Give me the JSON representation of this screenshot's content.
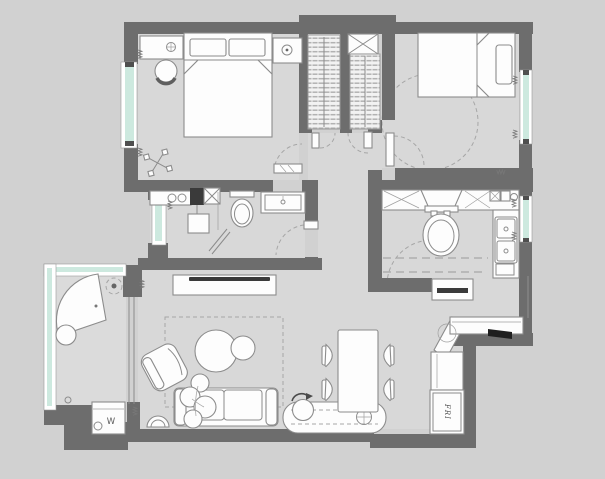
{
  "plan": {
    "labels": {
      "washing_machine": "W",
      "fridge": "FRI"
    }
  },
  "colors": {
    "background": "#d1d1d1",
    "floor": "#d8d8d8",
    "balcony_floor": "#dbdbdb",
    "wall": "#6d6d6d",
    "window_glass": "#cde9df",
    "furniture_fill": "#fdfdfd",
    "furniture_line": "#8c8c8c",
    "dash_line": "#a6a6a6",
    "dark_detail": "#3a3a3a"
  }
}
